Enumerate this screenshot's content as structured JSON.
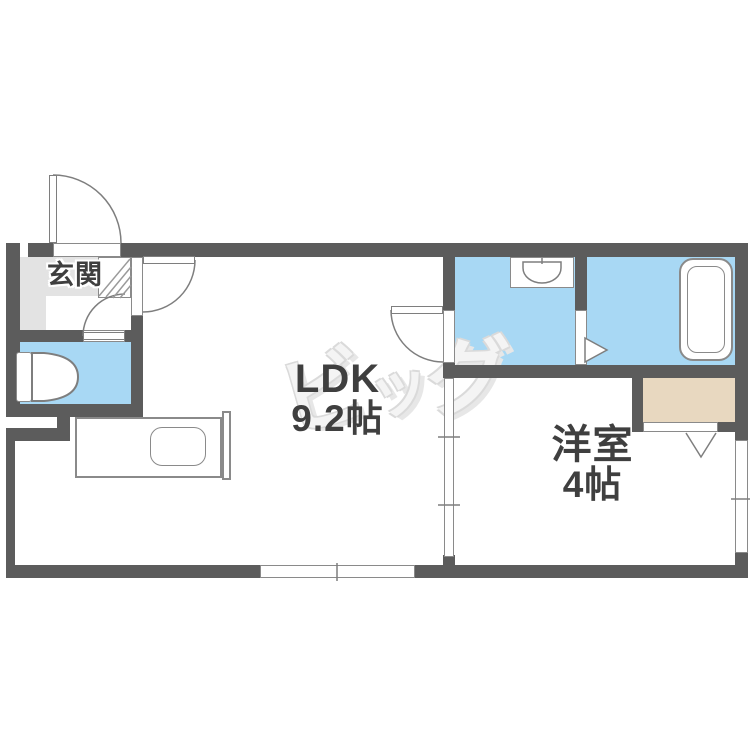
{
  "rooms": {
    "entrance": {
      "label": "玄関"
    },
    "ldk": {
      "label": "LDK",
      "size": "9.2帖"
    },
    "western_room": {
      "label": "洋室",
      "size": "4帖"
    }
  },
  "watermark": {
    "chars": [
      "ビ",
      "ッ",
      "グ"
    ]
  },
  "colors": {
    "wall": "#5c5c5c",
    "water": "#a8d8f4",
    "entrance_floor": "#e3e3e3",
    "closet": "#e8d8c0",
    "label": "#3f3f3f",
    "line": "#8a8a8a",
    "watermark_fill": "#f4f4f4",
    "watermark_edge": "#dadada"
  },
  "icons": [
    "entrance-door-swing",
    "room-door-swing",
    "toilet",
    "kitchen-counter",
    "kitchen-sink",
    "washbasin",
    "bathtub",
    "bath-folding-door-arrow",
    "closet-folding-door",
    "sliding-window",
    "sliding-partition",
    "shoe-cabinet"
  ]
}
